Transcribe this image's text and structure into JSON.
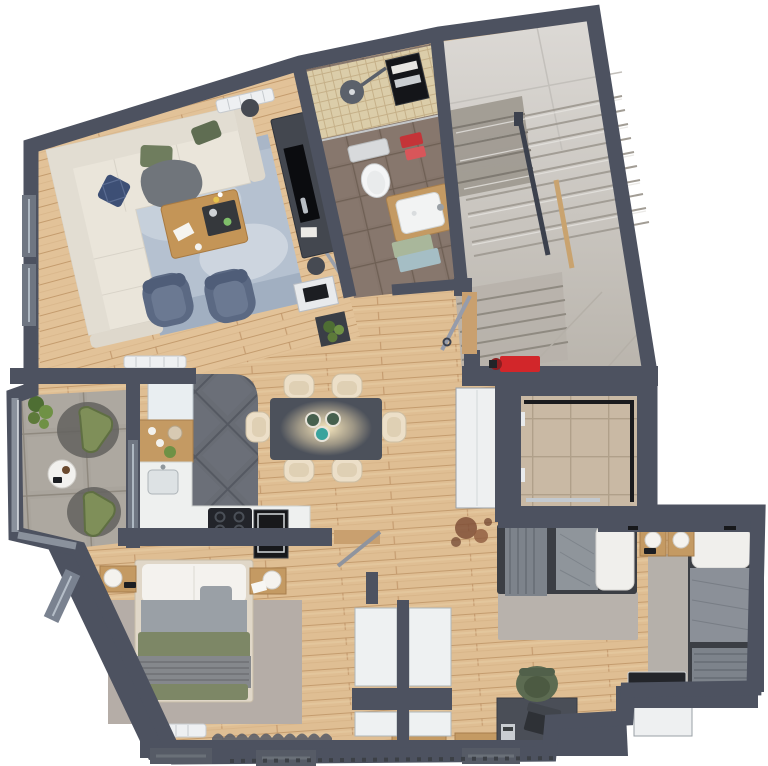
{
  "meta": {
    "kind": "3d-rendered-floor-plan",
    "view": "top-down",
    "width_px": 768,
    "height_px": 766
  },
  "palette": {
    "bg": "#ffffff",
    "wall": "#4d5260",
    "wallDark": "#3c404c",
    "wallLight": "#6a7078",
    "wood": "#dfbe93",
    "woodLine": "#c49c6e",
    "bathTile": "#84746a",
    "mosaic": "#dbcda9",
    "stair": "#d3d0cb",
    "stairDark": "#b3aea6",
    "stone": "#a9a49c",
    "kitchenTile": "#686c74",
    "elevatorTile": "#c9b9a4",
    "rugBlue": "#b5c1d0",
    "rugGray": "#b8b2ac",
    "sofa": "#eae5da",
    "sofaTrim": "#ded8cc",
    "armchair": "#5b6983",
    "chairCream": "#ecdfc8",
    "tableDark": "#4c515b",
    "woodFurniture": "#c49a63",
    "white": "#f0f2f3",
    "bedGreen": "#7d8766",
    "bedGray": "#979ca2",
    "bedDark": "#3b3e44",
    "pillowGreen": "#6f7d5e",
    "pillowBlue": "#3d4f75",
    "blanketGray": "#70757b",
    "greenChair": "#5c6b51",
    "plantGreen": "#6f9145",
    "plantDark": "#4e6e33",
    "red": "#d2262a",
    "black": "#17181b",
    "lamp": "#f4f2ee",
    "glow": "#ffe9b8",
    "glass": "#8a919c"
  },
  "rooms": [
    {
      "id": "living-room",
      "furniture": [
        "corner-sofa",
        "throw-pillows",
        "knit-blanket",
        "blue-area-rug",
        "coffee-table",
        "armchair",
        "armchair",
        "tv-sideboard",
        "tv",
        "radiator",
        "pouf",
        "pouf",
        "side-table",
        "plant-stand"
      ]
    },
    {
      "id": "bathroom",
      "furniture": [
        "walk-in-shower",
        "shower-head",
        "toilet",
        "vanity-with-sink",
        "red-towels",
        "towel-stack",
        "storage-shelf"
      ]
    },
    {
      "id": "stairwell",
      "furniture": [
        "upper-flight",
        "lower-flight",
        "landing-tiles",
        "handrail",
        "wood-handrail",
        "fire-extinguisher",
        "entry-door"
      ]
    },
    {
      "id": "dining-area",
      "furniture": [
        "dining-table",
        "pendant-light-glow",
        "plates",
        "dining-chair",
        "dining-chair",
        "dining-chair",
        "dining-chair",
        "dining-chair",
        "dining-chair",
        "tall-white-cabinet"
      ]
    },
    {
      "id": "kitchen",
      "furniture": [
        "island-table",
        "wood-worktop",
        "l-shaped-counter",
        "sink",
        "cooktop",
        "oven-column",
        "radiator",
        "diamond-tile-floor"
      ]
    },
    {
      "id": "balcony",
      "furniture": [
        "bean-bag",
        "bean-bag",
        "round-rug",
        "round-rug",
        "round-table",
        "coffee-cup",
        "plant"
      ]
    },
    {
      "id": "elevator",
      "furniture": [
        "tiled-cab-floor",
        "door-frame"
      ]
    },
    {
      "id": "master-bedroom",
      "furniture": [
        "double-bed",
        "pillows",
        "green-throw",
        "gray-runner",
        "nightstand",
        "nightstand",
        "table-lamp",
        "table-lamp",
        "area-rug",
        "radiator",
        "window-bay",
        "curtains"
      ]
    },
    {
      "id": "twin-bedroom",
      "furniture": [
        "single-bed",
        "single-bed",
        "nightstand",
        "nightstand",
        "table-lamp",
        "table-lamp",
        "area-rug",
        "runner-rug",
        "media-console",
        "white-closet"
      ]
    },
    {
      "id": "hallway",
      "furniture": [
        "built-in-wardrobe",
        "white-panel-doors",
        "desk",
        "office-chair",
        "laptop",
        "books",
        "spilled-plant-decor",
        "entry-threshold"
      ]
    }
  ]
}
